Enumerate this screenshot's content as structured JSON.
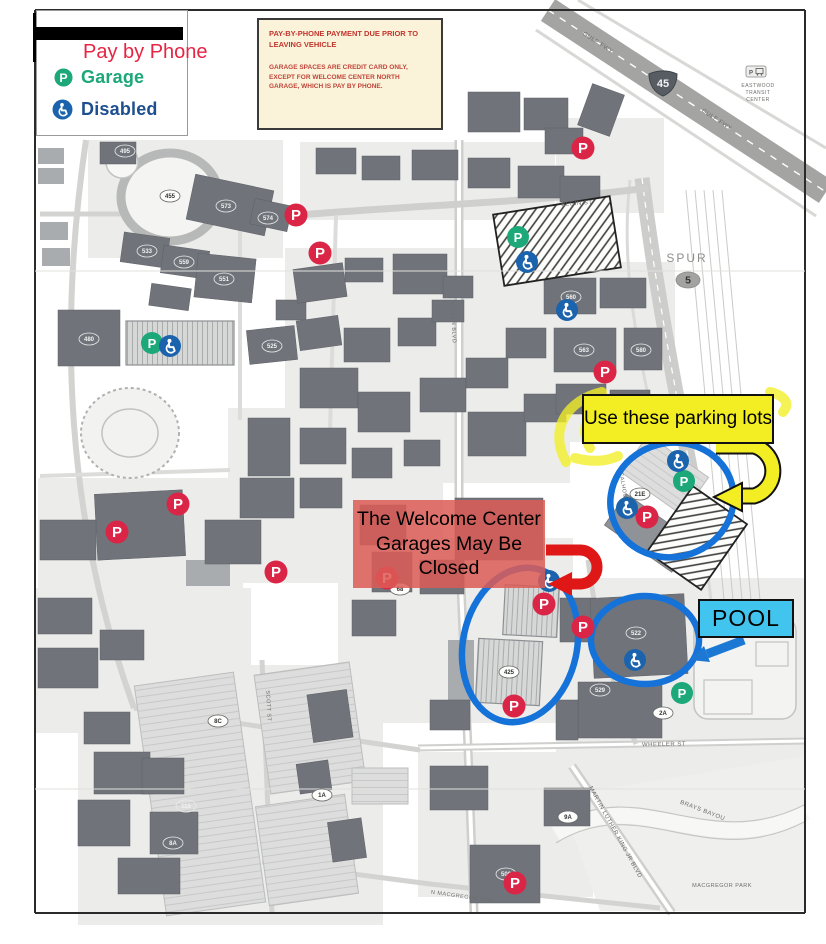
{
  "legend": {
    "title": "Pay by Phone",
    "items": [
      {
        "label": "Garage",
        "type": "garage"
      },
      {
        "label": "Disabled",
        "type": "disabled"
      }
    ]
  },
  "notice": {
    "title": "PAY-BY-PHONE PAYMENT DUE PRIOR TO LEAVING VEHICLE",
    "body": "GARAGE SPACES ARE CREDIT CARD ONLY, EXCEPT FOR WELCOME CENTER NORTH GARAGE, WHICH IS PAY BY PHONE."
  },
  "callouts": {
    "use_lots": {
      "text": "Use these parking lots",
      "bg": "#f2ee23"
    },
    "welcome_center": {
      "text": "The Welcome Center Garages May Be Closed",
      "bg": "rgba(220,92,86,0.85)"
    },
    "pool": {
      "text": "POOL",
      "bg": "#41c4ee"
    }
  },
  "colors": {
    "red_marker": "#da2546",
    "green_marker": "#1ca878",
    "blue_marker": "#1b64ad",
    "circle": "#1472d8",
    "yellow_arrow": "#f2ee23",
    "red_arrow": "#e01717",
    "blue_arrow": "#1d78d4",
    "building": "#70747a",
    "parcel": "#ececea",
    "park": "#efefed"
  },
  "map": {
    "marker_letter": "P",
    "shields": {
      "interstate": {
        "label": "45",
        "x": 663,
        "y": 83
      },
      "spur_text": {
        "label": "SPUR",
        "x": 687,
        "y": 262
      },
      "spur_num": {
        "label": "5",
        "x": 688,
        "y": 280
      }
    },
    "streets": [
      {
        "t": "GULF FWY",
        "x": 597,
        "y": 44,
        "r": 33,
        "s": 6
      },
      {
        "t": "GULF FWY",
        "x": 716,
        "y": 121,
        "r": 33,
        "s": 6
      },
      {
        "t": "ELGIN ST",
        "x": 577,
        "y": 205,
        "r": -4,
        "s": 6
      },
      {
        "t": "WHEELER ST",
        "x": 664,
        "y": 746,
        "r": -1,
        "s": 6
      },
      {
        "t": "MARTIN LUTHER KING JR BLVD",
        "x": 614,
        "y": 833,
        "r": 61,
        "s": 6
      },
      {
        "t": "BRAYS BAYOU",
        "x": 702,
        "y": 812,
        "r": 21,
        "s": 6
      },
      {
        "t": "MACGREGOR PARK",
        "x": 722,
        "y": 887,
        "r": 0,
        "s": 5.5
      },
      {
        "t": "N MACGREGOR WAY",
        "x": 462,
        "y": 898,
        "r": 8,
        "s": 5.5
      },
      {
        "t": "CALHOUN RD",
        "x": 623,
        "y": 493,
        "r": 80,
        "s": 5.5
      },
      {
        "t": "SCOTT ST",
        "x": 267,
        "y": 706,
        "r": 87,
        "s": 5.5
      },
      {
        "t": "CULLEN BLVD",
        "x": 452,
        "y": 322,
        "r": 88,
        "s": 5.5
      },
      {
        "t": "EASTWOOD",
        "x": 758,
        "y": 87,
        "r": 0,
        "s": 5
      },
      {
        "t": "TRANSIT",
        "x": 758,
        "y": 94,
        "r": 0,
        "s": 5
      },
      {
        "t": "CENTER",
        "x": 758,
        "y": 101,
        "r": 0,
        "s": 5
      }
    ],
    "bldg_labels": [
      {
        "t": "455",
        "x": 170,
        "y": 196,
        "dk": false
      },
      {
        "t": "495",
        "x": 125,
        "y": 151,
        "dk": true
      },
      {
        "t": "573",
        "x": 226,
        "y": 206,
        "dk": true
      },
      {
        "t": "574",
        "x": 268,
        "y": 218,
        "dk": true
      },
      {
        "t": "533",
        "x": 147,
        "y": 251,
        "dk": true
      },
      {
        "t": "559",
        "x": 184,
        "y": 262,
        "dk": true
      },
      {
        "t": "551",
        "x": 224,
        "y": 279,
        "dk": true
      },
      {
        "t": "480",
        "x": 89,
        "y": 339,
        "dk": true
      },
      {
        "t": "525",
        "x": 272,
        "y": 346,
        "dk": true
      },
      {
        "t": "560",
        "x": 571,
        "y": 297,
        "dk": true
      },
      {
        "t": "563",
        "x": 584,
        "y": 350,
        "dk": true
      },
      {
        "t": "580",
        "x": 641,
        "y": 350,
        "dk": true
      },
      {
        "t": "522",
        "x": 636,
        "y": 633,
        "dk": true
      },
      {
        "t": "529",
        "x": 600,
        "y": 690,
        "dk": true
      },
      {
        "t": "500",
        "x": 506,
        "y": 874,
        "dk": true
      },
      {
        "t": "425",
        "x": 509,
        "y": 672,
        "dk": false
      },
      {
        "t": "68",
        "x": 400,
        "y": 589,
        "dk": false
      },
      {
        "t": "115",
        "x": 186,
        "y": 806,
        "dk": true
      },
      {
        "t": "8A",
        "x": 173,
        "y": 843,
        "dk": true
      },
      {
        "t": "8C",
        "x": 218,
        "y": 721,
        "dk": false
      },
      {
        "t": "9A",
        "x": 568,
        "y": 817,
        "dk": false
      },
      {
        "t": "2A",
        "x": 663,
        "y": 713,
        "dk": false
      },
      {
        "t": "1A",
        "x": 322,
        "y": 795,
        "dk": false
      },
      {
        "t": "21E",
        "x": 640,
        "y": 494,
        "dk": false
      }
    ],
    "markers": {
      "red": [
        [
          296,
          215
        ],
        [
          320,
          253
        ],
        [
          583,
          148
        ],
        [
          605,
          372
        ],
        [
          178,
          504
        ],
        [
          117,
          532
        ],
        [
          276,
          572
        ],
        [
          387,
          578
        ],
        [
          647,
          517
        ],
        [
          544,
          604
        ],
        [
          583,
          627
        ],
        [
          514,
          706
        ],
        [
          515,
          883
        ]
      ],
      "green": [
        [
          152,
          343
        ],
        [
          518,
          237
        ],
        [
          684,
          481
        ],
        [
          682,
          693
        ]
      ],
      "disabled": [
        [
          170,
          346
        ],
        [
          527,
          262
        ],
        [
          567,
          310
        ],
        [
          678,
          461
        ],
        [
          627,
          508
        ],
        [
          549,
          581
        ],
        [
          635,
          660
        ]
      ]
    },
    "circles": [
      [
        672,
        500,
        62,
        57,
        -15
      ],
      [
        520,
        645,
        57,
        78,
        12
      ],
      [
        645,
        640,
        54,
        44,
        0
      ]
    ],
    "arrows": {
      "yellow": {
        "path": "M 716,446 L 754,446 A 26 26 0 0 1 754,496 L 742,496",
        "head": "714,497 742,483 742,511"
      },
      "red": {
        "path": "M 546,550 L 580,550 A 17 17 0 0 1 580,584 L 572,584",
        "head": "548,584 572,572 572,596"
      },
      "blue": {
        "path": "M 744,640 L 707,654",
        "head": "690,660 704,646 710,662"
      }
    },
    "scribbles": [
      "M 566,462 C 548,428 568,400 602,392",
      "M 590,448 C 578,426 590,408 612,402",
      "M 770,392 C 786,396 790,404 783,412",
      "M 575,458 C 590,462 606,462 618,456"
    ],
    "parcels": [
      [
        88,
        140,
        195,
        118
      ],
      [
        300,
        142,
        255,
        78
      ],
      [
        285,
        248,
        285,
        235
      ],
      [
        540,
        262,
        135,
        180
      ],
      [
        228,
        408,
        215,
        175
      ],
      [
        38,
        478,
        205,
        175
      ],
      [
        338,
        538,
        235,
        185
      ],
      [
        556,
        578,
        248,
        175
      ],
      [
        36,
        588,
        215,
        145
      ],
      [
        418,
        752,
        175,
        145
      ],
      [
        78,
        665,
        305,
        260
      ],
      [
        556,
        118,
        108,
        95
      ],
      [
        590,
        742,
        216,
        56
      ]
    ],
    "park": "560,796 806,756 806,911 600,911",
    "roads": [
      {
        "d": "M 556,834 C 640,781 706,864 806,812",
        "w": 16,
        "c": "#f7f7f5"
      },
      {
        "d": "M 556,826 C 640,772 706,856 806,804",
        "w": 1.2,
        "c": "#c6c6c4"
      },
      {
        "d": "M 556,843 C 640,790 706,874 806,821",
        "w": 1.2,
        "c": "#c6c6c4"
      },
      {
        "d": "M 548,10 L 826,192",
        "w": 26,
        "c": "#a4a4a2"
      },
      {
        "d": "M 548,10 L 826,192",
        "w": 1.4,
        "c": "#ffffff",
        "da": "7 7"
      },
      {
        "d": "M 536,30 L 816,216",
        "w": 3,
        "c": "#d8d8d6"
      },
      {
        "d": "M 578,0 L 826,148",
        "w": 3,
        "c": "#d8d8d6"
      },
      {
        "d": "M 642,178 C 652,260 664,330 692,478",
        "w": 15,
        "c": "#cdcdcb"
      },
      {
        "d": "M 642,178 C 652,260 664,330 692,478",
        "w": 1.2,
        "c": "#ffffff",
        "da": "6 6"
      },
      {
        "d": "M 630,180 C 622,250 630,320 658,440",
        "w": 3,
        "c": "#dadad8"
      },
      {
        "d": "M 692,478 C 702,530 708,570 712,610",
        "w": 3,
        "c": "#dadad8"
      },
      {
        "d": "M 459,140 L 459,540 L 468,748 L 474,912",
        "w": 9,
        "c": "#cfcfcd"
      },
      {
        "d": "M 459,140 L 459,540 L 468,748 L 474,912",
        "w": 4,
        "c": "#ffffff"
      },
      {
        "d": "M 288,216 C 400,206 540,202 648,188",
        "w": 7,
        "c": "#cfcfcd"
      },
      {
        "d": "M 418,748 L 806,741",
        "w": 7,
        "c": "#cfcfcd"
      },
      {
        "d": "M 418,748 L 806,741",
        "w": 3,
        "c": "#ffffff"
      },
      {
        "d": "M 572,766 L 672,913",
        "w": 9,
        "c": "#cfcfcd"
      },
      {
        "d": "M 572,766 L 672,913",
        "w": 4,
        "c": "#ffffff"
      },
      {
        "d": "M 660,908 L 430,884 L 262,862",
        "w": 5,
        "c": "#d3d3d1"
      },
      {
        "d": "M 86,140 C 58,330 66,520 134,708",
        "w": 6,
        "c": "#d3d3d1"
      },
      {
        "d": "M 40,214 L 290,214",
        "w": 5,
        "c": "#d3d3d1"
      },
      {
        "d": "M 262,660 L 272,913",
        "w": 5,
        "c": "#d3d3d1"
      },
      {
        "d": "M 588,560 C 598,640 618,700 636,744",
        "w": 5,
        "c": "#d3d3d1"
      },
      {
        "d": "M 134,708 L 420,750",
        "w": 5,
        "c": "#d3d3d1"
      },
      {
        "d": "M 240,216 L 240,420",
        "w": 4,
        "c": "#dcdcda"
      },
      {
        "d": "M 336,216 L 330,430",
        "w": 4,
        "c": "#dcdcda"
      },
      {
        "d": "M 40,476 L 230,470",
        "w": 4,
        "c": "#dcdcda"
      }
    ],
    "features": {
      "track": [
        170,
        197,
        49,
        44
      ],
      "stadium": [
        130,
        433,
        49,
        45
      ],
      "ballfield": [
        122,
        162,
        16
      ],
      "recfield": [
        694,
        617,
        102,
        102
      ],
      "courts": [
        [
          704,
          680,
          48,
          34
        ],
        [
          756,
          642,
          32,
          24
        ]
      ]
    },
    "buildings": {
      "dark": [
        [
          100,
          142,
          36,
          22
        ],
        [
          190,
          182,
          80,
          46,
          12
        ],
        [
          252,
          202,
          38,
          26,
          12
        ],
        [
          122,
          235,
          46,
          30,
          8
        ],
        [
          162,
          248,
          46,
          28,
          8
        ],
        [
          196,
          256,
          58,
          44,
          6
        ],
        [
          58,
          310,
          62,
          56
        ],
        [
          248,
          328,
          48,
          34,
          -6
        ],
        [
          276,
          300,
          30,
          20
        ],
        [
          150,
          286,
          40,
          22,
          8
        ],
        [
          316,
          148,
          40,
          26
        ],
        [
          362,
          156,
          38,
          24
        ],
        [
          412,
          150,
          46,
          30
        ],
        [
          468,
          92,
          52,
          40
        ],
        [
          524,
          98,
          44,
          32
        ],
        [
          545,
          128,
          38,
          26
        ],
        [
          468,
          158,
          42,
          30
        ],
        [
          518,
          166,
          46,
          32
        ],
        [
          584,
          88,
          34,
          44,
          20
        ],
        [
          560,
          176,
          40,
          26
        ],
        [
          295,
          266,
          50,
          34,
          -8
        ],
        [
          345,
          258,
          38,
          24
        ],
        [
          393,
          254,
          54,
          40
        ],
        [
          443,
          276,
          30,
          22
        ],
        [
          298,
          318,
          42,
          30,
          -8
        ],
        [
          344,
          328,
          46,
          34
        ],
        [
          300,
          368,
          58,
          40
        ],
        [
          398,
          318,
          38,
          28
        ],
        [
          432,
          300,
          32,
          22
        ],
        [
          358,
          392,
          52,
          40
        ],
        [
          420,
          378,
          46,
          34
        ],
        [
          466,
          358,
          42,
          30
        ],
        [
          506,
          328,
          40,
          30
        ],
        [
          468,
          412,
          58,
          44
        ],
        [
          524,
          394,
          42,
          28
        ],
        [
          300,
          428,
          46,
          36
        ],
        [
          248,
          418,
          42,
          58
        ],
        [
          240,
          478,
          54,
          40
        ],
        [
          300,
          478,
          42,
          30
        ],
        [
          352,
          448,
          40,
          30
        ],
        [
          404,
          440,
          36,
          26
        ],
        [
          544,
          278,
          52,
          36
        ],
        [
          600,
          278,
          46,
          30
        ],
        [
          554,
          328,
          62,
          44
        ],
        [
          624,
          328,
          38,
          42
        ],
        [
          556,
          384,
          50,
          30
        ],
        [
          610,
          390,
          40,
          36
        ],
        [
          560,
          598,
          36,
          44
        ],
        [
          420,
          560,
          44,
          34
        ],
        [
          372,
          552,
          40,
          40
        ],
        [
          352,
          600,
          44,
          36
        ],
        [
          430,
          700,
          40,
          30
        ],
        [
          592,
          596,
          94,
          80,
          -3
        ],
        [
          578,
          682,
          84,
          56
        ],
        [
          430,
          766,
          58,
          44
        ],
        [
          470,
          845,
          70,
          58
        ],
        [
          544,
          788,
          46,
          38
        ],
        [
          84,
          712,
          46,
          32
        ],
        [
          94,
          752,
          56,
          42
        ],
        [
          78,
          800,
          52,
          46
        ],
        [
          142,
          758,
          42,
          36
        ],
        [
          150,
          812,
          48,
          42
        ],
        [
          118,
          858,
          62,
          36
        ],
        [
          38,
          598,
          54,
          36
        ],
        [
          38,
          648,
          60,
          40
        ],
        [
          100,
          630,
          44,
          30
        ],
        [
          96,
          492,
          88,
          66,
          -3
        ],
        [
          205,
          520,
          56,
          44
        ],
        [
          40,
          520,
          56,
          40
        ],
        [
          310,
          692,
          40,
          48,
          -8
        ],
        [
          298,
          762,
          32,
          30,
          -8
        ],
        [
          330,
          820,
          34,
          40,
          -8
        ],
        [
          556,
          700,
          22,
          40
        ],
        [
          360,
          505,
          46,
          40
        ],
        [
          455,
          498,
          88,
          62
        ]
      ],
      "light": [
        [
          38,
          148,
          26,
          16
        ],
        [
          38,
          168,
          26,
          16
        ],
        [
          40,
          222,
          28,
          18
        ],
        [
          42,
          248,
          28,
          18
        ],
        [
          448,
          640,
          26,
          60
        ],
        [
          186,
          560,
          44,
          26
        ]
      ],
      "garage": [
        [
          126,
          321,
          108,
          44
        ],
        [
          504,
          586,
          54,
          50,
          3
        ],
        [
          477,
          640,
          64,
          64,
          3
        ]
      ],
      "lot": [
        [
          150,
          678,
          100,
          232,
          -8
        ],
        [
          262,
          668,
          96,
          120,
          -8
        ],
        [
          262,
          800,
          90,
          100,
          -8
        ],
        [
          352,
          768,
          56,
          36
        ],
        [
          628,
          452,
          74,
          46,
          35
        ]
      ],
      "darklot": [
        [
          608,
          514,
          82,
          38,
          35
        ]
      ],
      "hatch": [
        [
          498,
          205,
          118,
          72,
          -9
        ],
        [
          664,
          498,
          66,
          80,
          35
        ]
      ]
    }
  }
}
